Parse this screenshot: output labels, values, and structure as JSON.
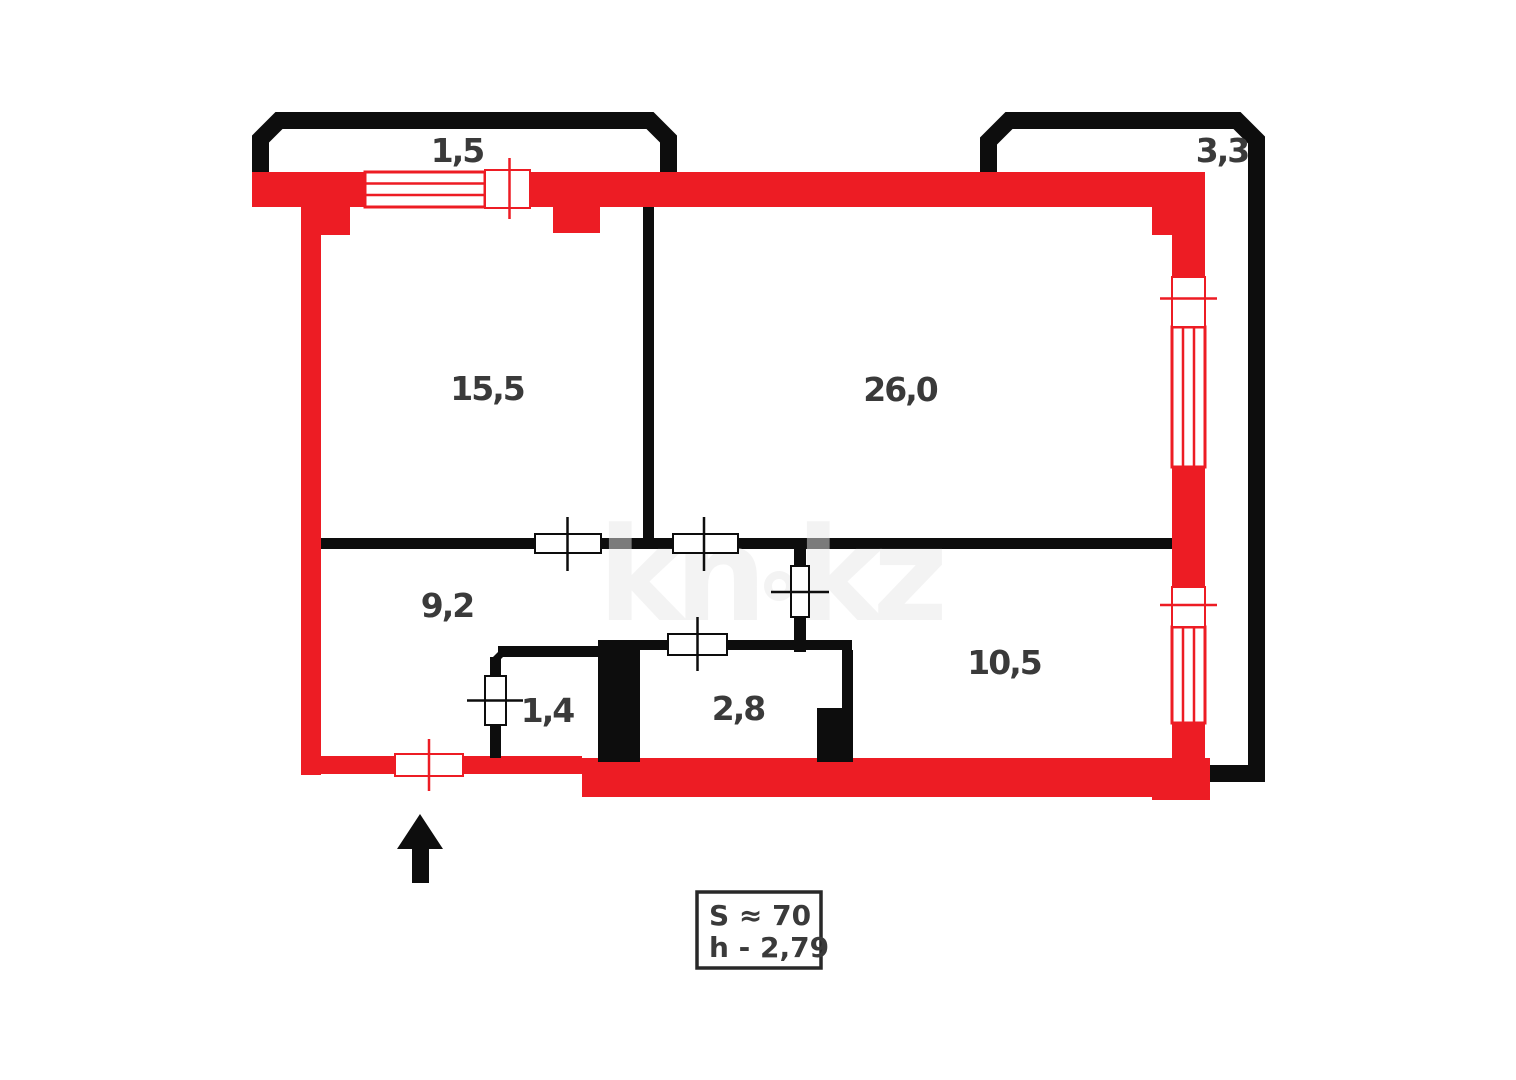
{
  "colors": {
    "wall_red": "#ed1c24",
    "wall_black": "#0d0d0d",
    "label_text": "#3a3a3a",
    "watermark_gray": "#e8e8e8"
  },
  "watermark": {
    "part1": "kn",
    "part2": "kz"
  },
  "labels": {
    "balcony_left": "1,5",
    "balcony_right": "3,3",
    "room_left": "15,5",
    "room_right": "26,0",
    "hall": "9,2",
    "closet": "1,4",
    "bathroom": "2,8",
    "kitchen": "10,5"
  },
  "info_box": {
    "line1": "S ≈ 70",
    "line2": "h - 2,79"
  }
}
